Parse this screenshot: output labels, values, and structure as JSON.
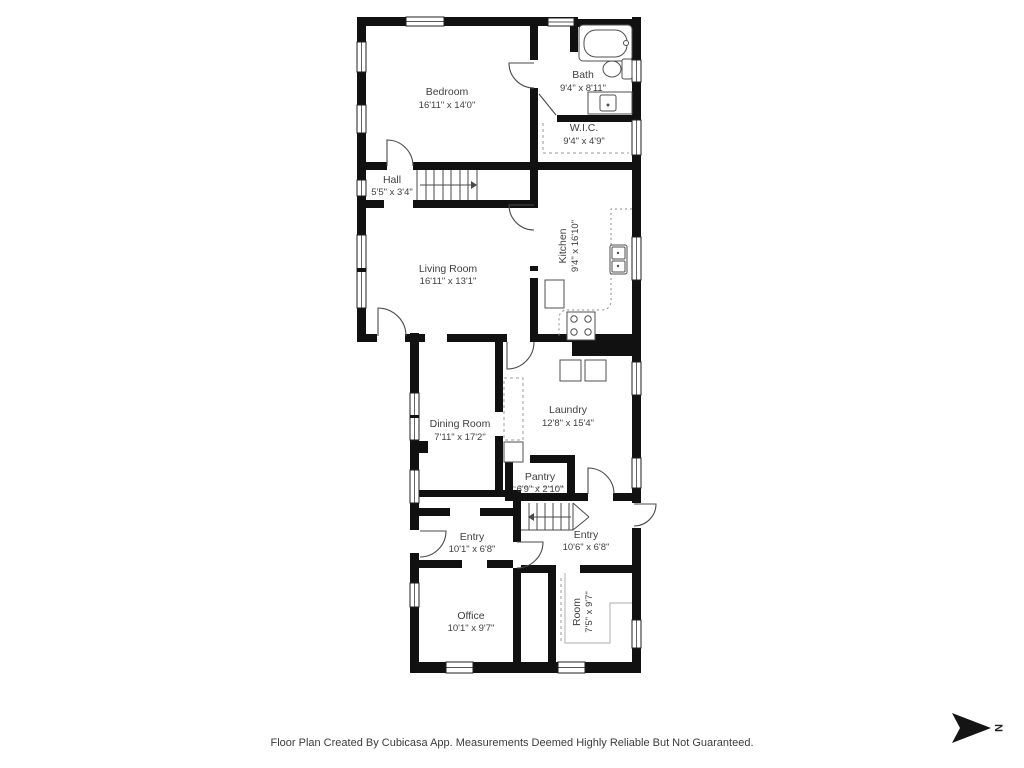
{
  "rooms": [
    {
      "id": "bedroom",
      "name": "Bedroom",
      "dimensions": "16'11\" x 14'0\""
    },
    {
      "id": "bath",
      "name": "Bath",
      "dimensions": "9'4\" x 8'11\""
    },
    {
      "id": "wic",
      "name": "W.I.C.",
      "dimensions": "9'4\" x 4'9\""
    },
    {
      "id": "hall",
      "name": "Hall",
      "dimensions": "5'5\" x 3'4\""
    },
    {
      "id": "living-room",
      "name": "Living Room",
      "dimensions": "16'11\" x 13'1\""
    },
    {
      "id": "kitchen",
      "name": "Kitchen",
      "dimensions": "9'4\" x 16'10\""
    },
    {
      "id": "dining-room",
      "name": "Dining Room",
      "dimensions": "7'11\" x 17'2\""
    },
    {
      "id": "laundry",
      "name": "Laundry",
      "dimensions": "12'8\" x 15'4\""
    },
    {
      "id": "pantry",
      "name": "Pantry",
      "dimensions": "6'9\" x 2'10\""
    },
    {
      "id": "entry-left",
      "name": "Entry",
      "dimensions": "10'1\" x 6'8\""
    },
    {
      "id": "entry-right",
      "name": "Entry",
      "dimensions": "10'6\" x 6'8\""
    },
    {
      "id": "office",
      "name": "Office",
      "dimensions": "10'1\" x 9'7\""
    },
    {
      "id": "room",
      "name": "Room",
      "dimensions": "7'5\" x 9'7\""
    }
  ],
  "fixtures": [
    "bathtub-icon",
    "toilet-icon",
    "bathroom-sink-icon",
    "kitchen-sink-icon",
    "stove-icon",
    "refrigerator-icon",
    "washer-icon",
    "dryer-icon",
    "stairs-up-icon",
    "stairs-entry-icon"
  ],
  "compass": {
    "north_label": "N"
  },
  "footer": {
    "disclaimer": "Floor Plan Created By Cubicasa App. Measurements Deemed Highly Reliable But Not Guaranteed."
  },
  "colors": {
    "wall": "#111111",
    "label_text": "#3f3f3f",
    "door_stroke": "#4a4a4a",
    "dashed": "#9a9a9a",
    "ceiling_line": "#bcbcbc",
    "background": "#ffffff"
  }
}
